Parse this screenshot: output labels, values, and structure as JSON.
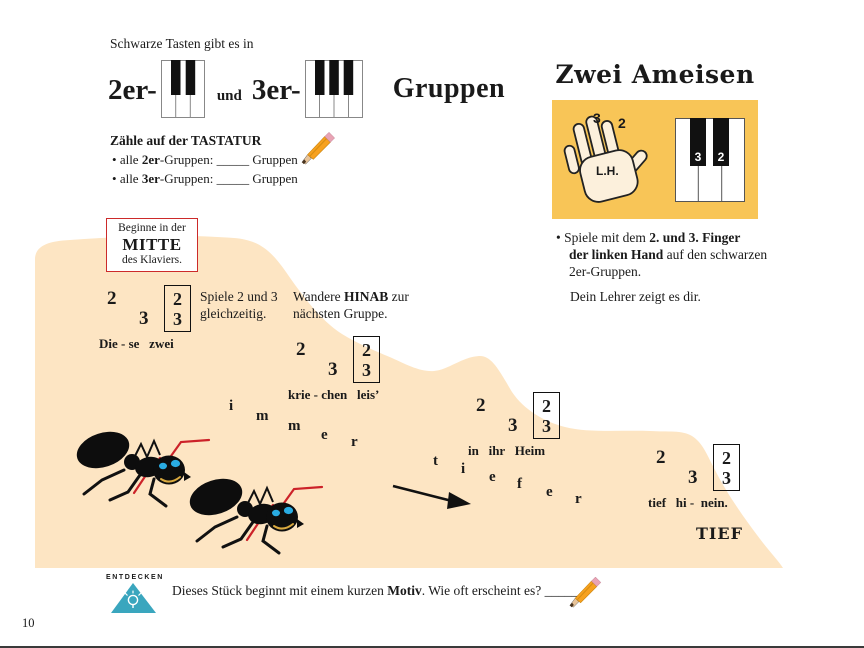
{
  "page_number": "10",
  "bullet": "•",
  "intro_line": "Schwarze Tasten gibt es in",
  "headline": {
    "g2": "2er-",
    "und": "und",
    "g3": "3er-",
    "gruppen": "Gruppen"
  },
  "count_task": {
    "title": "Zähle auf der TASTATUR",
    "item1": {
      "pre": "alle ",
      "bold": "2er",
      "mid": "-Gruppen: ",
      "blank": "_____",
      "post": " Gruppen"
    },
    "item2": {
      "pre": "alle ",
      "bold": "3er",
      "mid": "-Gruppen: ",
      "blank": "_____",
      "post": " Gruppen"
    }
  },
  "piece_title": "Zwei Ameisen",
  "hand_card": {
    "finger3": "3",
    "finger2": "2",
    "hand_label": "L.H.",
    "key3": "3",
    "key2": "2"
  },
  "instruction": {
    "line1_pre": "Spiele mit dem ",
    "line1_bold": "2. und 3. Finger",
    "line2_bold": "der linken Hand",
    "line2_rest": " auf den schwarzen",
    "line3": "2er-Gruppen.",
    "teacher": "Dein Lehrer zeigt es dir."
  },
  "start_box": {
    "l1": "Beginne in der",
    "l2": "MITTE",
    "l3": "des Klaviers."
  },
  "captions": {
    "simul_l1": "Spiele 2 und 3",
    "simul_l2": "gleichzeitig.",
    "wander_pre": "Wandere ",
    "wander_bold": "HINAB",
    "wander_post": " zur",
    "wander_l2": "nächsten Gruppe."
  },
  "phrases": [
    {
      "n1": "2",
      "n2": "3",
      "bt": "2",
      "bb": "3",
      "lyrics": "Die - se   zwei"
    },
    {
      "n1": "2",
      "n2": "3",
      "bt": "2",
      "bb": "3",
      "lyrics": "krie - chen   leis’"
    },
    {
      "n1": "2",
      "n2": "3",
      "bt": "2",
      "bb": "3",
      "lyrics": "in   ihr   Heim"
    },
    {
      "n1": "2",
      "n2": "3",
      "bt": "2",
      "bb": "3",
      "lyrics": "tief   hi -  nein."
    }
  ],
  "scatter": {
    "immer": [
      "i",
      "m",
      "m",
      "e",
      "r"
    ],
    "tiefer": [
      "t",
      "i",
      "e",
      "f",
      "e",
      "r"
    ]
  },
  "tief_label": "TIEF",
  "discover": {
    "logo": "ENTDECKEN",
    "pre": "Dieses Stück beginnt mit einem kurzen ",
    "bold": "Motiv",
    "post": ". Wie oft erscheint es? ",
    "blank": "_____"
  },
  "colors": {
    "hill_tan": "#FDE5C3",
    "card_yellow": "#F8C557",
    "accent_red": "#CC2A2A",
    "logo_teal": "#3AA6BE",
    "ant_eye_blue": "#29ABE2",
    "antenna_red": "#CC2229",
    "pencil_orange": "#F7A11E"
  }
}
